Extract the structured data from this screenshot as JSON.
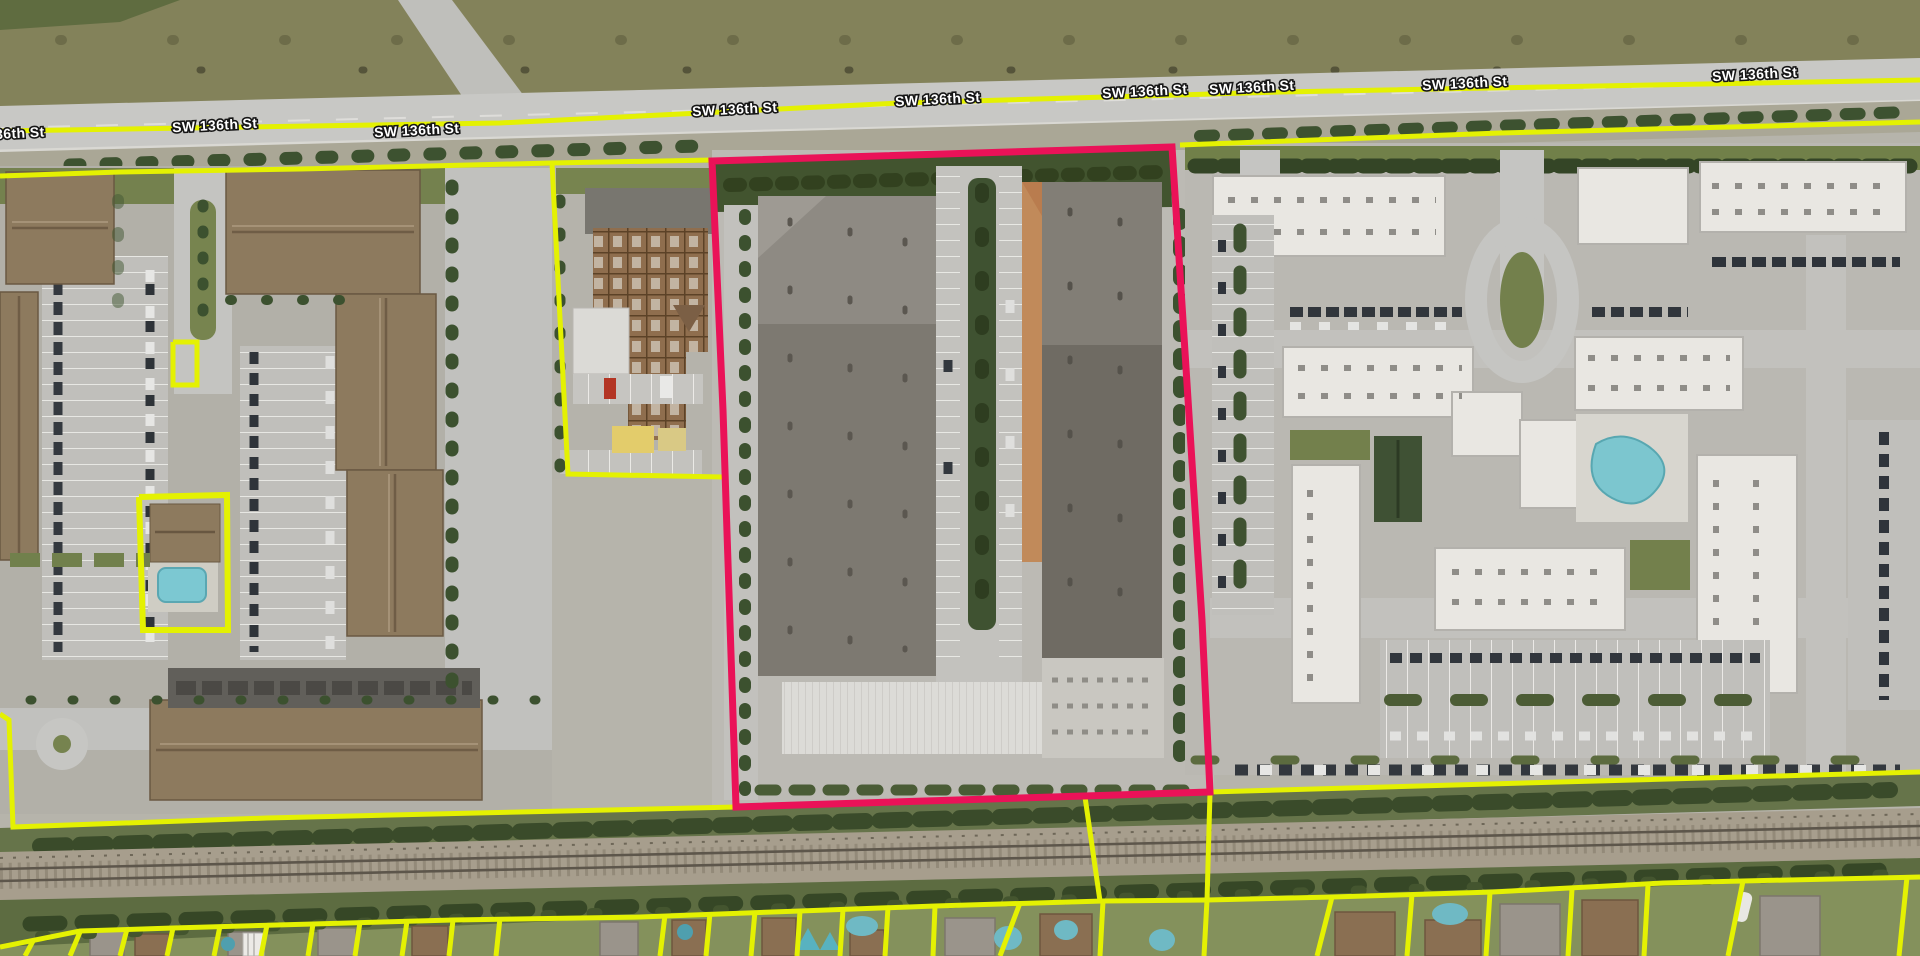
{
  "map": {
    "street": {
      "name": "SW 136th St"
    },
    "colors": {
      "parcel_line": "#e4f102",
      "selected_outline": "#ea1258"
    },
    "labels": [
      {
        "text": "136th St",
        "x": 16,
        "y": 138,
        "rot": -3
      },
      {
        "text": "SW 136th St",
        "x": 215,
        "y": 130,
        "rot": -3
      },
      {
        "text": "SW 136th St",
        "x": 417,
        "y": 135,
        "rot": -3
      },
      {
        "text": "SW 136th St",
        "x": 735,
        "y": 114,
        "rot": -3
      },
      {
        "text": "SW 136th St",
        "x": 938,
        "y": 104,
        "rot": -3
      },
      {
        "text": "SW 136th St",
        "x": 1145,
        "y": 96,
        "rot": -3
      },
      {
        "text": "SW 136th St",
        "x": 1252,
        "y": 92,
        "rot": -3
      },
      {
        "text": "SW 136th St",
        "x": 1465,
        "y": 88,
        "rot": -3
      },
      {
        "text": "SW 136th St",
        "x": 1755,
        "y": 79,
        "rot": -3
      }
    ],
    "selected_parcel": {
      "points": "712,161 1172,147 1202,620 1210,792 736,807 723,410",
      "stroke_width": 7
    },
    "parcel_lines": [
      {
        "name": "street-centerline",
        "points": "0,131 500,123 900,103 1280,92 1920,80",
        "w": 5
      },
      {
        "name": "north-boundary-west",
        "points": "0,176 120,172 300,169 470,165 552,163 712,160",
        "w": 5
      },
      {
        "name": "north-boundary-east",
        "points": "1180,145 1500,133 1920,122",
        "w": 5
      },
      {
        "name": "utility-parcel-boundary",
        "points": "552,163 568,474 723,477",
        "w": 5
      },
      {
        "name": "gatehouse-parcel-box",
        "points": "173,342 197,342 197,385 173,385 173,342",
        "w": 5
      },
      {
        "name": "clubhouse-parcel-box",
        "points": "139,497 227,495 228,630 143,630 139,497",
        "w": 6
      },
      {
        "name": "south-boundary-west",
        "points": "0,714 9,720 13,827 267,818 520,812 736,807",
        "w": 5
      },
      {
        "name": "south-boundary-east",
        "points": "1210,792 1560,782 1920,772",
        "w": 5
      },
      {
        "name": "corridor-cross-line-east",
        "points": "1210,793 1207,901",
        "w": 5
      },
      {
        "name": "corridor-cross-line-mid",
        "points": "1085,797 1100,901",
        "w": 5
      },
      {
        "name": "residential-block-line",
        "points": "0,947 80,931 173,928 313,924 453,920 640,917 800,911 935,906 1103,901 1207,900 1332,897 1493,892 1663,883 1743,881 1920,877",
        "w": 5
      }
    ],
    "lot_dividers": [
      [
        33,
        941,
        25,
        956
      ],
      [
        80,
        932,
        70,
        956
      ],
      [
        127,
        929,
        120,
        956
      ],
      [
        173,
        928,
        167,
        956
      ],
      [
        220,
        926,
        214,
        956
      ],
      [
        267,
        925,
        261,
        956
      ],
      [
        313,
        924,
        308,
        956
      ],
      [
        360,
        922,
        355,
        956
      ],
      [
        407,
        921,
        402,
        956
      ],
      [
        453,
        920,
        449,
        956
      ],
      [
        500,
        918,
        496,
        956
      ],
      [
        665,
        915,
        660,
        956
      ],
      [
        710,
        913,
        706,
        956
      ],
      [
        755,
        911,
        751,
        956
      ],
      [
        800,
        911,
        797,
        956
      ],
      [
        843,
        909,
        840,
        956
      ],
      [
        888,
        907,
        885,
        956
      ],
      [
        935,
        906,
        933,
        956
      ],
      [
        1020,
        903,
        1000,
        956
      ],
      [
        1103,
        901,
        1100,
        956
      ],
      [
        1207,
        900,
        1204,
        956
      ],
      [
        1332,
        897,
        1317,
        956
      ],
      [
        1412,
        894,
        1407,
        956
      ],
      [
        1490,
        892,
        1486,
        956
      ],
      [
        1572,
        889,
        1568,
        956
      ],
      [
        1648,
        885,
        1644,
        956
      ],
      [
        1743,
        881,
        1728,
        956
      ],
      [
        1907,
        877,
        1899,
        956
      ]
    ]
  }
}
